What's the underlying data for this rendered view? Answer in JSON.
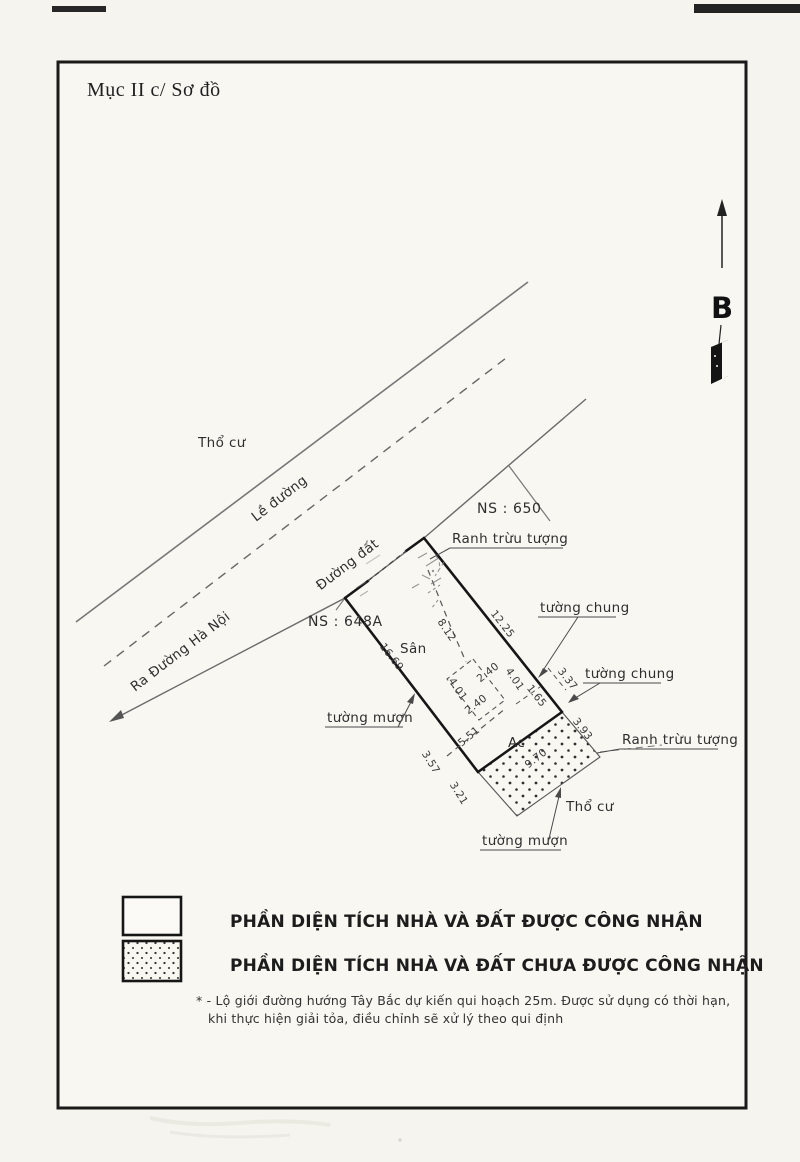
{
  "page": {
    "title": "Mục II c/ Sơ đồ"
  },
  "compass": {
    "north_label": "B"
  },
  "site_plan": {
    "area_labels": {
      "tho_cu_top": "Thổ cư",
      "tho_cu_bottom": "Thổ cư",
      "san": "Sân",
      "ac": "Ac"
    },
    "road_labels": {
      "le_duong": "Lề đường",
      "duong_dat": "Đường đất",
      "ra_duong_ha_noi": "Ra Đường Hà Nội"
    },
    "parcel_labels": {
      "ns_650": "NS : 650",
      "ns_648a": "NS : 648A"
    },
    "boundary_labels": {
      "ranh_truu_tuong_top": "Ranh trừu tượng",
      "ranh_truu_tuong_bottom": "Ranh trừu tượng",
      "tuong_chung_upper": "tường chung",
      "tuong_chung_lower": "tường chung",
      "tuong_muon_left": "tường mượn",
      "tuong_muon_bottom": "tường mượn"
    },
    "dimensions": {
      "right_edge": "12.25",
      "left_edge": "16.69",
      "interior_depth": "8.12",
      "house_front": "5.51",
      "house_width_a": "4.01",
      "house_width_b": "4.01",
      "house_depth_a": "2.40",
      "house_depth_b": "2.40",
      "edge_1_65": "1.65",
      "edge_3_37": "3.37",
      "edge_3_93": "3.93",
      "strip_length": "9.70",
      "edge_3_57": "3.57",
      "strip_end": "3.21"
    }
  },
  "legend": {
    "items": [
      {
        "label": "PHẦN DIỆN TÍCH NHÀ VÀ ĐẤT ĐƯỢC CÔNG NHẬN"
      },
      {
        "label": "PHẦN DIỆN TÍCH NHÀ VÀ ĐẤT CHƯA ĐƯỢC CÔNG NHẬN"
      }
    ],
    "note_line1": "* - Lộ giới đường hướng Tây Bắc dự kiến qui hoạch 25m. Được sử dụng có thời hạn,",
    "note_line2": "khi thực hiện giải tỏa, điều chỉnh sẽ xử lý theo qui định"
  },
  "colors": {
    "ink": "#1c1c1c",
    "paper": "#f5f4ef"
  }
}
